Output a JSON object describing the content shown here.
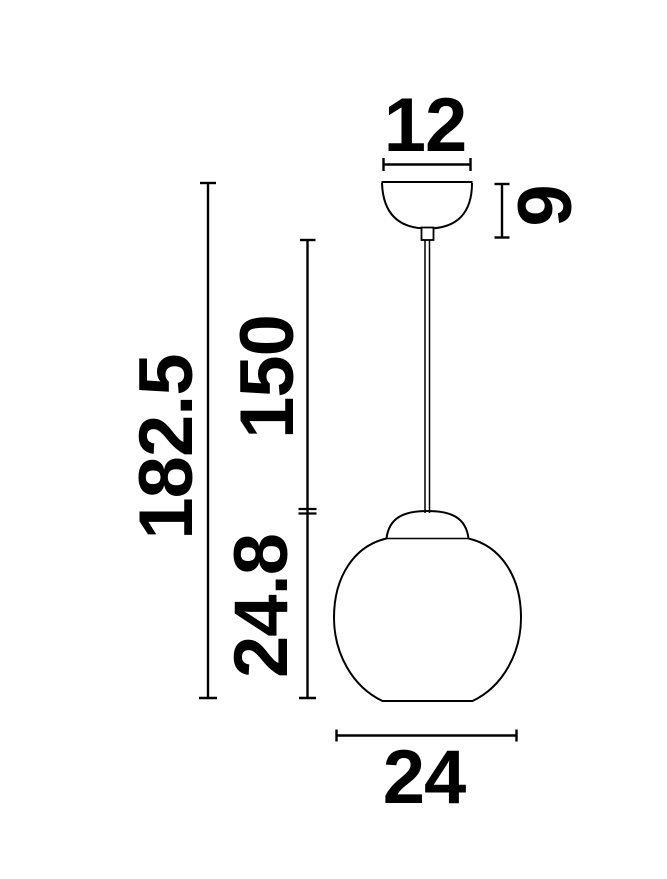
{
  "diagram": {
    "type": "technical-dimension-drawing",
    "subject": "pendant-lamp",
    "colors": {
      "line": "#000000",
      "background": "#ffffff"
    },
    "labels": {
      "canopy_width": "12",
      "canopy_height": "9",
      "total_height": "182.5",
      "cord_length": "150",
      "shade_height": "24.8",
      "shade_width": "24"
    }
  }
}
